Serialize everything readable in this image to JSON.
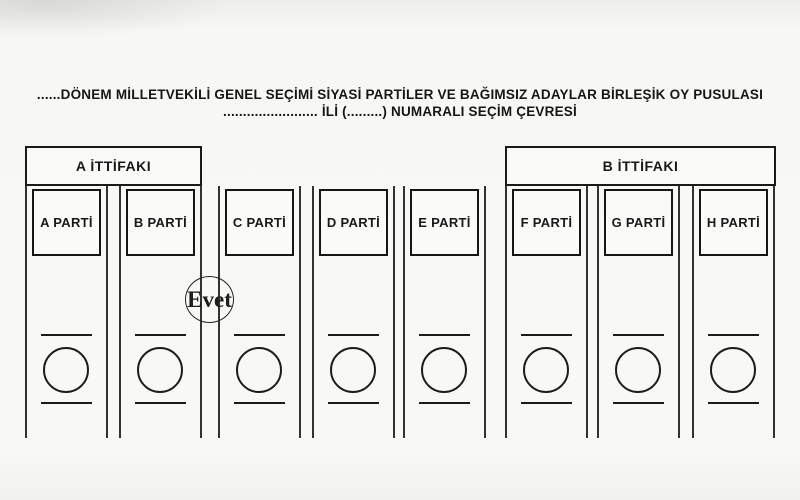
{
  "header": {
    "line1": "......DÖNEM MİLLETVEKİLİ GENEL SEÇİMİ SİYASİ PARTİLER VE BAĞIMSIZ ADAYLAR BİRLEŞİK OY PUSULASI",
    "line2": "........................ İLİ (.........) NUMARALI SEÇİM ÇEVRESİ"
  },
  "alliances": [
    {
      "label": "A İTTİFAKI",
      "members": [
        "A PARTİ",
        "B PARTİ"
      ]
    },
    {
      "label": "B İTTİFAKI",
      "members": [
        "F PARTİ",
        "G PARTİ",
        "H PARTİ"
      ]
    }
  ],
  "parties": [
    {
      "name": "A PARTİ"
    },
    {
      "name": "B PARTİ"
    },
    {
      "name": "C PARTİ"
    },
    {
      "name": "D PARTİ"
    },
    {
      "name": "E PARTİ"
    },
    {
      "name": "F PARTİ"
    },
    {
      "name": "G PARTİ"
    },
    {
      "name": "H PARTİ"
    }
  ],
  "stamp": {
    "label": "Evet"
  },
  "colors": {
    "ink": "#1c1c1c",
    "paper": "#f8f8f5"
  }
}
